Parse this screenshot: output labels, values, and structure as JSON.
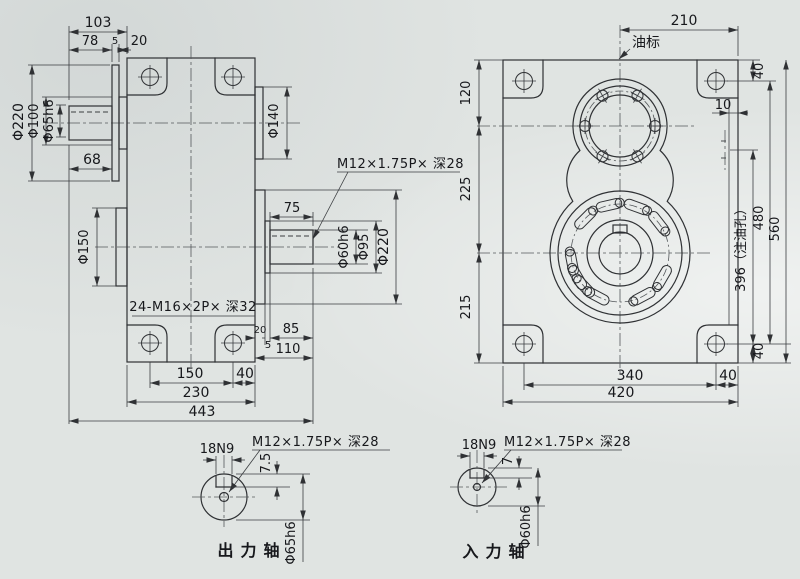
{
  "colors": {
    "paper": "#e0e4e2",
    "line": "#2f3134",
    "text": "#17181c"
  },
  "side_view": {
    "dims": {
      "d103": "103",
      "d78": "78",
      "d5": "5",
      "d20": "20",
      "phi220_in": "Φ220",
      "phi100": "Φ100",
      "phi65h6": "Φ65h6",
      "d68": "68",
      "phi150": "Φ150",
      "phi140": "Φ140",
      "d75": "75",
      "phi60h6": "Φ60h6",
      "phi95": "Φ95",
      "phi220_out": "Φ220",
      "d20b": "20",
      "d5b": "5",
      "d85": "85",
      "d110": "110",
      "d150": "150",
      "d40": "40",
      "d230": "230",
      "d443": "443"
    },
    "notes": {
      "tap_note": "M12×1.75P× 深28",
      "bolt_note": "24-M16×2P× 深32"
    }
  },
  "front_view": {
    "dims": {
      "d210": "210",
      "d120": "120",
      "d225": "225",
      "d215": "215",
      "d40_top": "40",
      "d10": "10",
      "d396": "396（注油孔）",
      "d480": "480",
      "d560": "560",
      "d40_right_bottom": "40",
      "d340": "340",
      "d40_bottom": "40",
      "d420": "420"
    },
    "labels": {
      "oil_gauge": "油标"
    }
  },
  "output_detail": {
    "keyway": "18N9",
    "tap_note": "M12×1.75P× 深28",
    "depth": "7.5",
    "diameter": "Φ65h6",
    "title": "出力轴"
  },
  "input_detail": {
    "keyway": "18N9",
    "tap_note": "M12×1.75P× 深28",
    "depth": "7",
    "diameter": "Φ60h6",
    "title": "入力轴"
  }
}
